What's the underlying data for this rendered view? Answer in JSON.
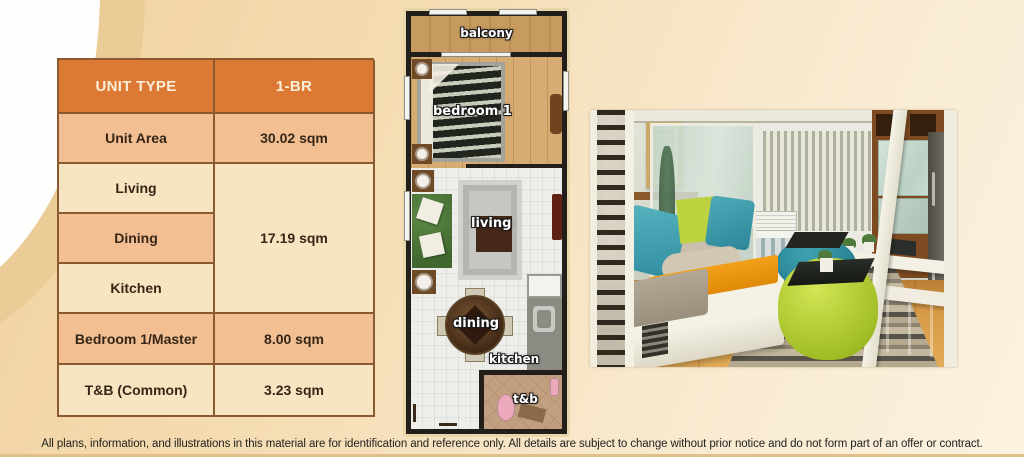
{
  "unit_table": {
    "columns": [
      "UNIT TYPE",
      "1-BR"
    ],
    "rows": [
      {
        "label": "Unit Area",
        "value": "30.02 sqm"
      },
      {
        "label": "Living"
      },
      {
        "label": "Dining"
      },
      {
        "label": "Kitchen"
      },
      {
        "label": "Bedroom 1/Master",
        "value": "8.00 sqm"
      },
      {
        "label": "T&B (Common)",
        "value": "3.23 sqm"
      }
    ],
    "living_dining_kitchen_value": "17.19 sqm"
  },
  "floorplan": {
    "rooms": {
      "balcony": "balcony",
      "bedroom1": "bedroom 1",
      "living": "living",
      "dining": "dining",
      "kitchen": "kitchen",
      "toilet_bath": "t&b"
    }
  },
  "page": {
    "disclaimer": "All plans, information, and illustrations in this material are for identification and reference only. All details are subject to change without prior notice and do not form part of an offer or contract."
  },
  "colors": {
    "accent_orange": "#DC7A35",
    "row_tan": "#F2BF93",
    "row_cream": "#F7E5C2",
    "background_cream": "#F4DAAE"
  }
}
